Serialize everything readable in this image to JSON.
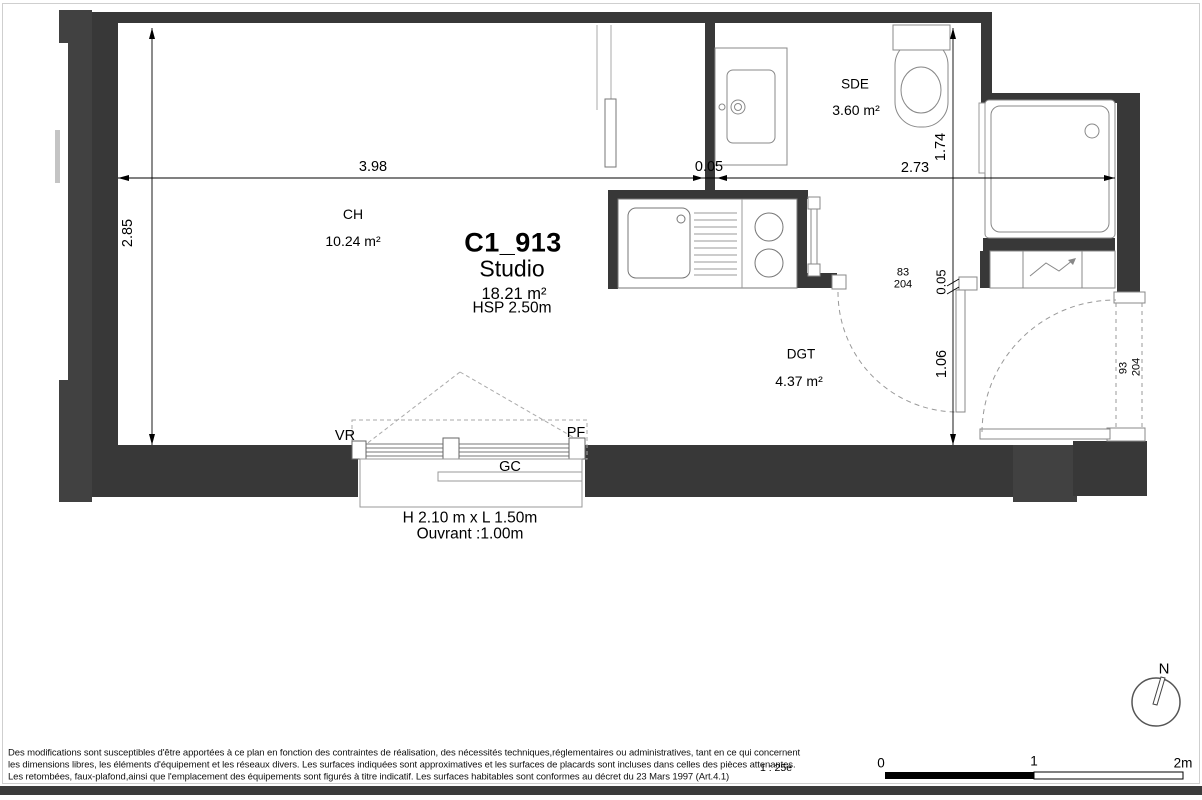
{
  "unit": {
    "title": "C1_913",
    "type": "Studio",
    "area": "18.21 m²",
    "ceiling": "HSP 2.50m"
  },
  "rooms": {
    "ch_name": "CH",
    "ch_area": "10.24 m²",
    "sde_name": "SDE",
    "sde_area": "3.60 m²",
    "dgt_name": "DGT",
    "dgt_area": "4.37 m²"
  },
  "dimensions": {
    "ch_width": "3.98",
    "partition": "0.05",
    "sde_width": "2.73",
    "ch_depth": "2.85",
    "sde_depth": "1.74",
    "closet_depth": "0.05",
    "entry_depth": "1.06",
    "sde_door_w": "83",
    "sde_door_h": "204",
    "entry_door_w": "93",
    "entry_door_h": "204"
  },
  "window": {
    "vr": "VR",
    "pf": "PF",
    "gc": "GC",
    "size": "H 2.10 m x  L 1.50m",
    "opening": "Ouvrant :1.00m"
  },
  "footer": {
    "disclaimer_line1": "Des modifications sont susceptibles d'être apportées à ce plan en fonction des contraintes de réalisation, des nécessités techniques,réglementaires ou administratives, tant en ce qui concernent",
    "disclaimer_line2": "les dimensions libres, les éléments d'équipement et les réseaux divers. Les surfaces indiquées sont approximatives et les surfaces de placards sont incluses dans celles des pièces attenantes.",
    "disclaimer_line3": "Les retombées, faux-plafond,ainsi que l'emplacement des équipements sont figurés à titre indicatif. Les surfaces habitables sont conformes au décret du 23 Mars 1997 (Art.4.1)",
    "scale_label": "1 : 25e",
    "scale_0": "0",
    "scale_1": "1",
    "scale_2": "2m",
    "north": "N"
  },
  "colors": {
    "wall": "#383838",
    "wall_outer": "#414141",
    "fixture_stroke": "#888888",
    "dash": "#999999"
  }
}
